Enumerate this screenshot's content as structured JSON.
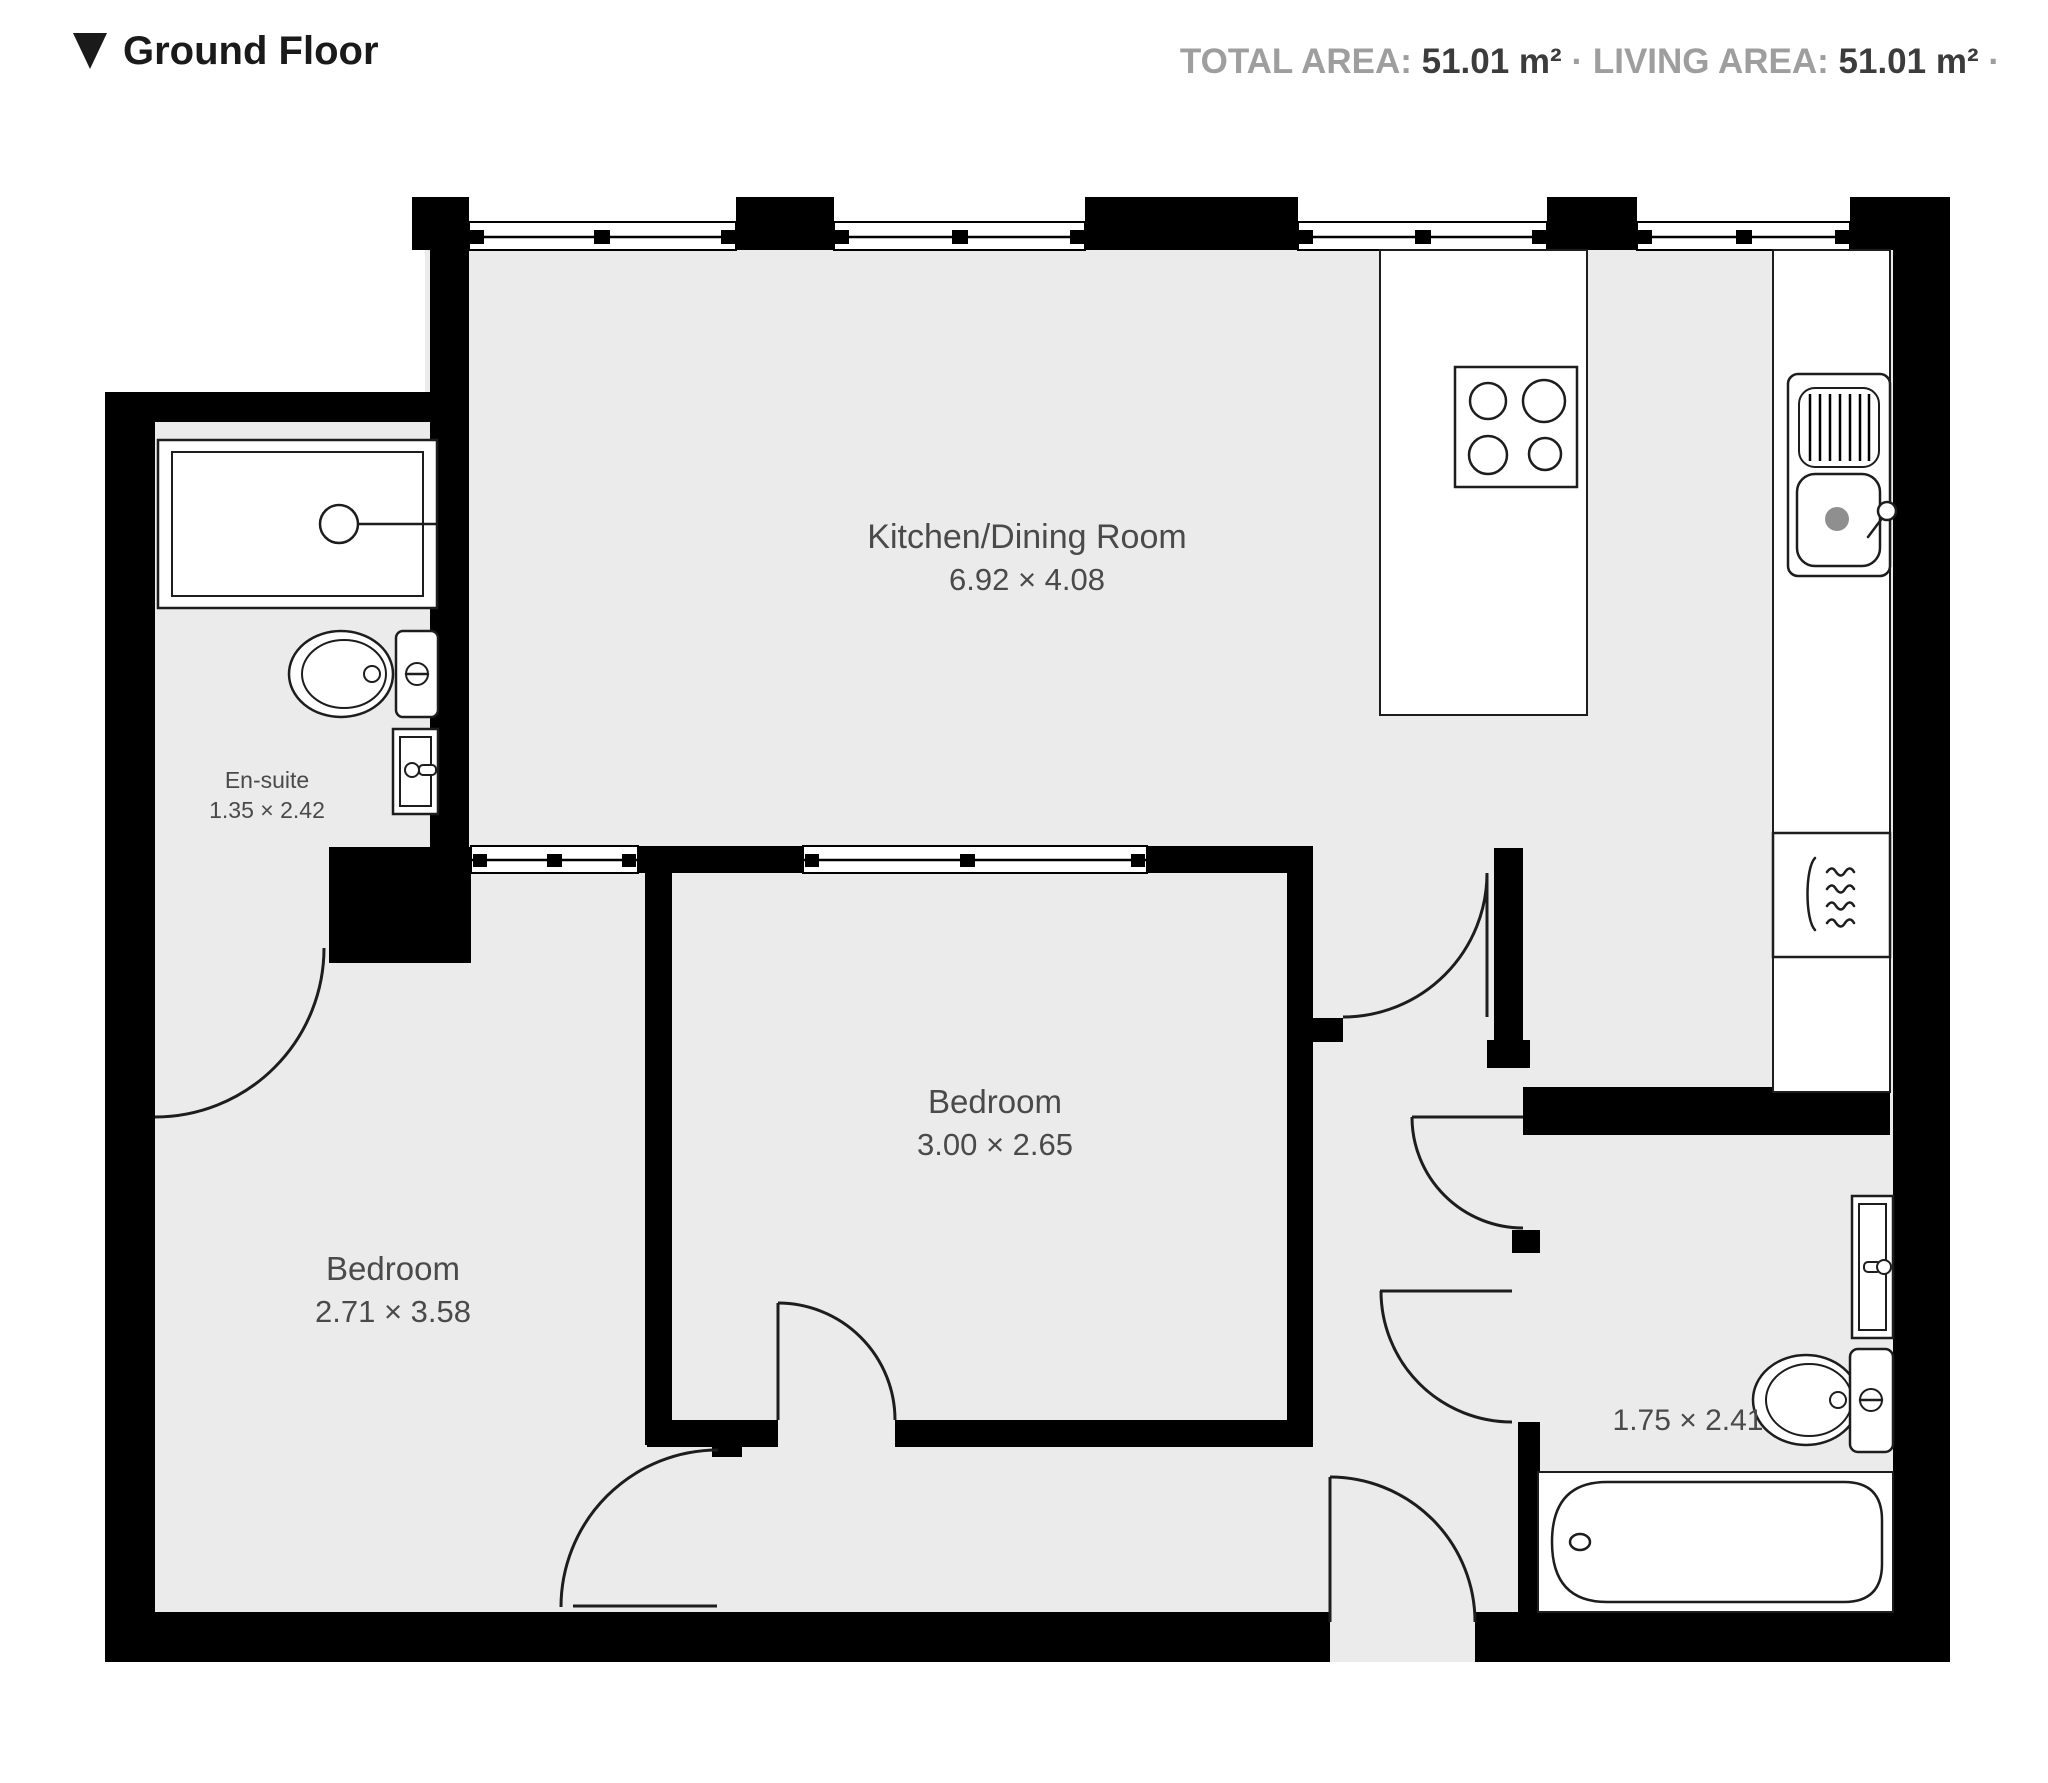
{
  "header": {
    "collapse_icon": "triangle-down",
    "title": "Ground Floor"
  },
  "stats": {
    "total_area_label": "TOTAL AREA:",
    "total_area_value": "51.01 m²",
    "separator": "·",
    "living_area_label": "LIVING AREA:",
    "living_area_value": "51.01 m²",
    "trailing_separator": "·"
  },
  "rooms": {
    "kitchen": {
      "name": "Kitchen/Dining Room",
      "dimensions": "6.92 × 4.08"
    },
    "ensuite": {
      "name": "En-suite",
      "dimensions": "1.35 × 2.42"
    },
    "bedroom_left": {
      "name": "Bedroom",
      "dimensions": "2.71 × 3.58"
    },
    "bedroom_middle": {
      "name": "Bedroom",
      "dimensions": "3.00 × 2.65"
    },
    "bathroom": {
      "dimensions": "1.75 × 2.41"
    }
  },
  "fixtures": {
    "ensuite": [
      "shower",
      "toilet",
      "sink"
    ],
    "kitchen": [
      "island-hob",
      "sink-drainer",
      "oven"
    ],
    "bathroom": [
      "sink",
      "toilet",
      "bathtub"
    ]
  },
  "colors": {
    "wall": "#000000",
    "floor": "#ebebeb",
    "fixture_stroke": "#1d1d1d",
    "room_label": "#4a4a4a",
    "stat_label": "#9e9e9e",
    "stat_value": "#3c3c3c",
    "title": "#1a1a1a",
    "background": "#ffffff"
  }
}
